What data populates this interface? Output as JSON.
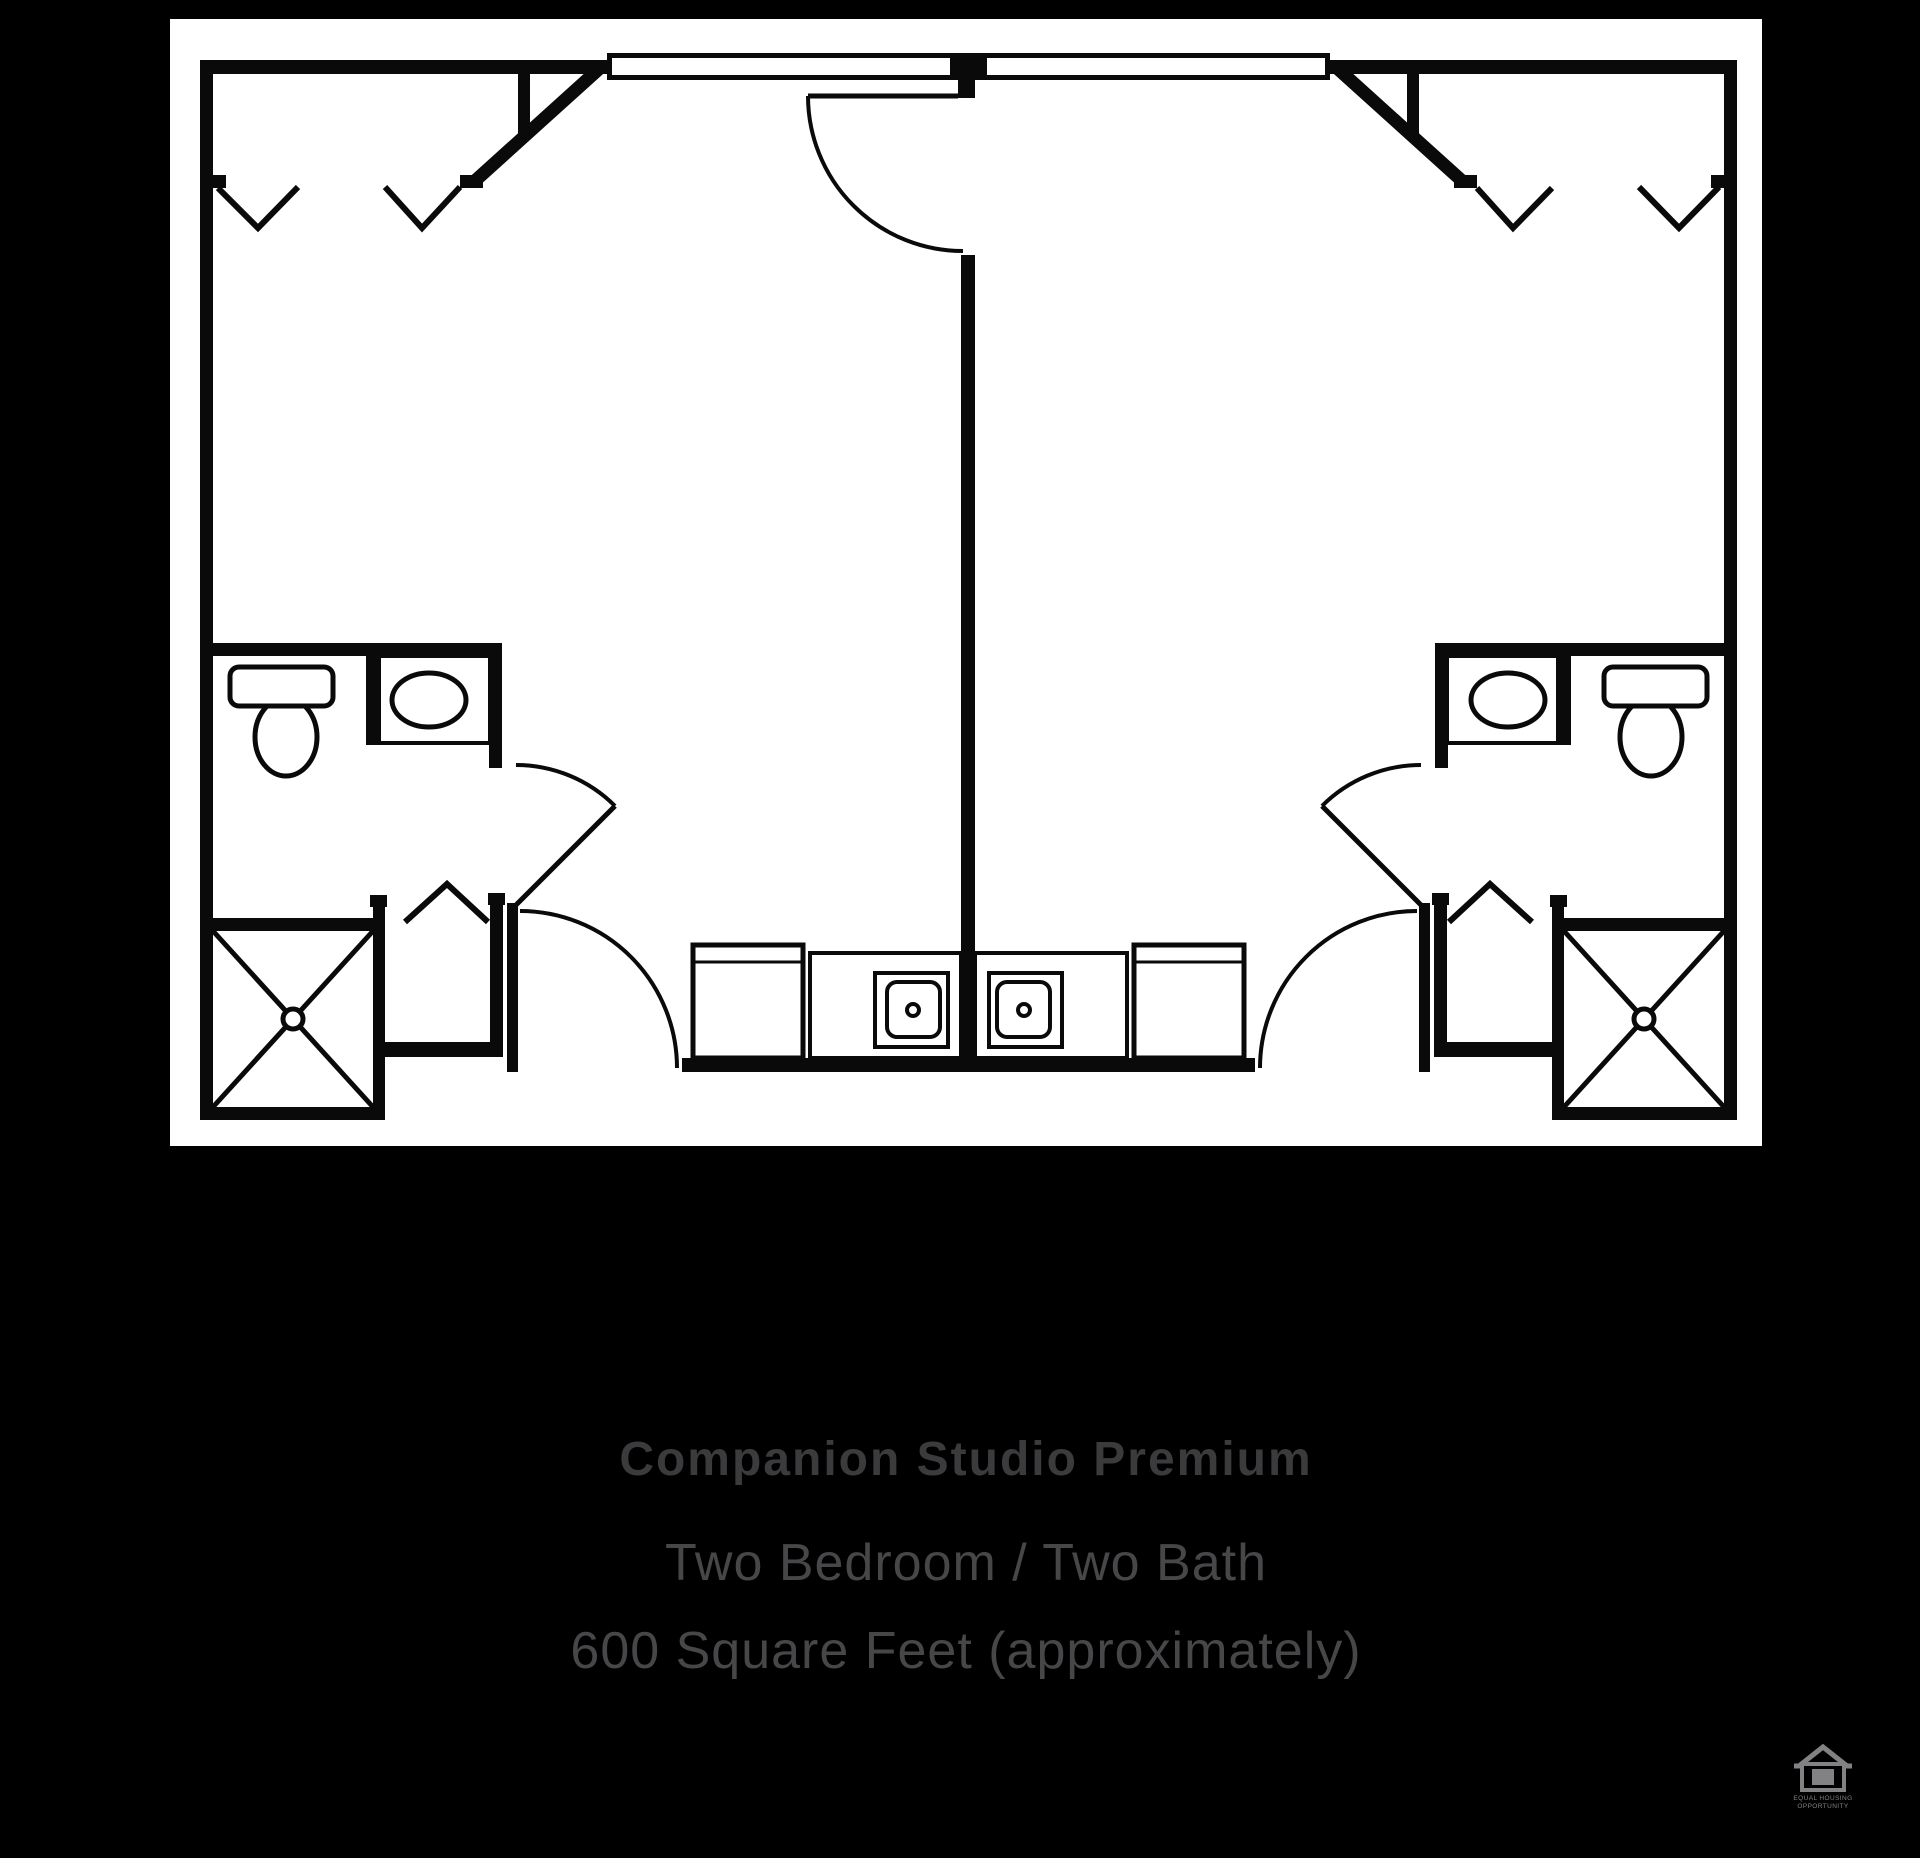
{
  "caption": {
    "title": "Companion Studio Premium",
    "line1": "Two Bedroom / Two Bath",
    "line2": "600 Square Feet (approximately)"
  },
  "footer": {
    "equal_housing_line1": "EQUAL HOUSING",
    "equal_housing_line2": "OPPORTUNITY"
  },
  "plan": {
    "name": "Companion Studio Premium floor plan",
    "units": 2,
    "rooms_per_unit": [
      "bedroom",
      "bathroom",
      "closet",
      "shower",
      "kitchenette"
    ],
    "icons": [
      "window-icon",
      "door-swing-icon",
      "closet-hanger-icon",
      "toilet-icon",
      "sink-icon",
      "shower-icon",
      "kitchen-sink-icon",
      "equal-housing-icon"
    ]
  },
  "colors": {
    "background": "#000000",
    "card": "#ffffff",
    "plan_line": "#0a0a0a",
    "title_text": "#3b3b3d",
    "subtitle_text": "#47474a",
    "logo_gray": "#828285"
  }
}
